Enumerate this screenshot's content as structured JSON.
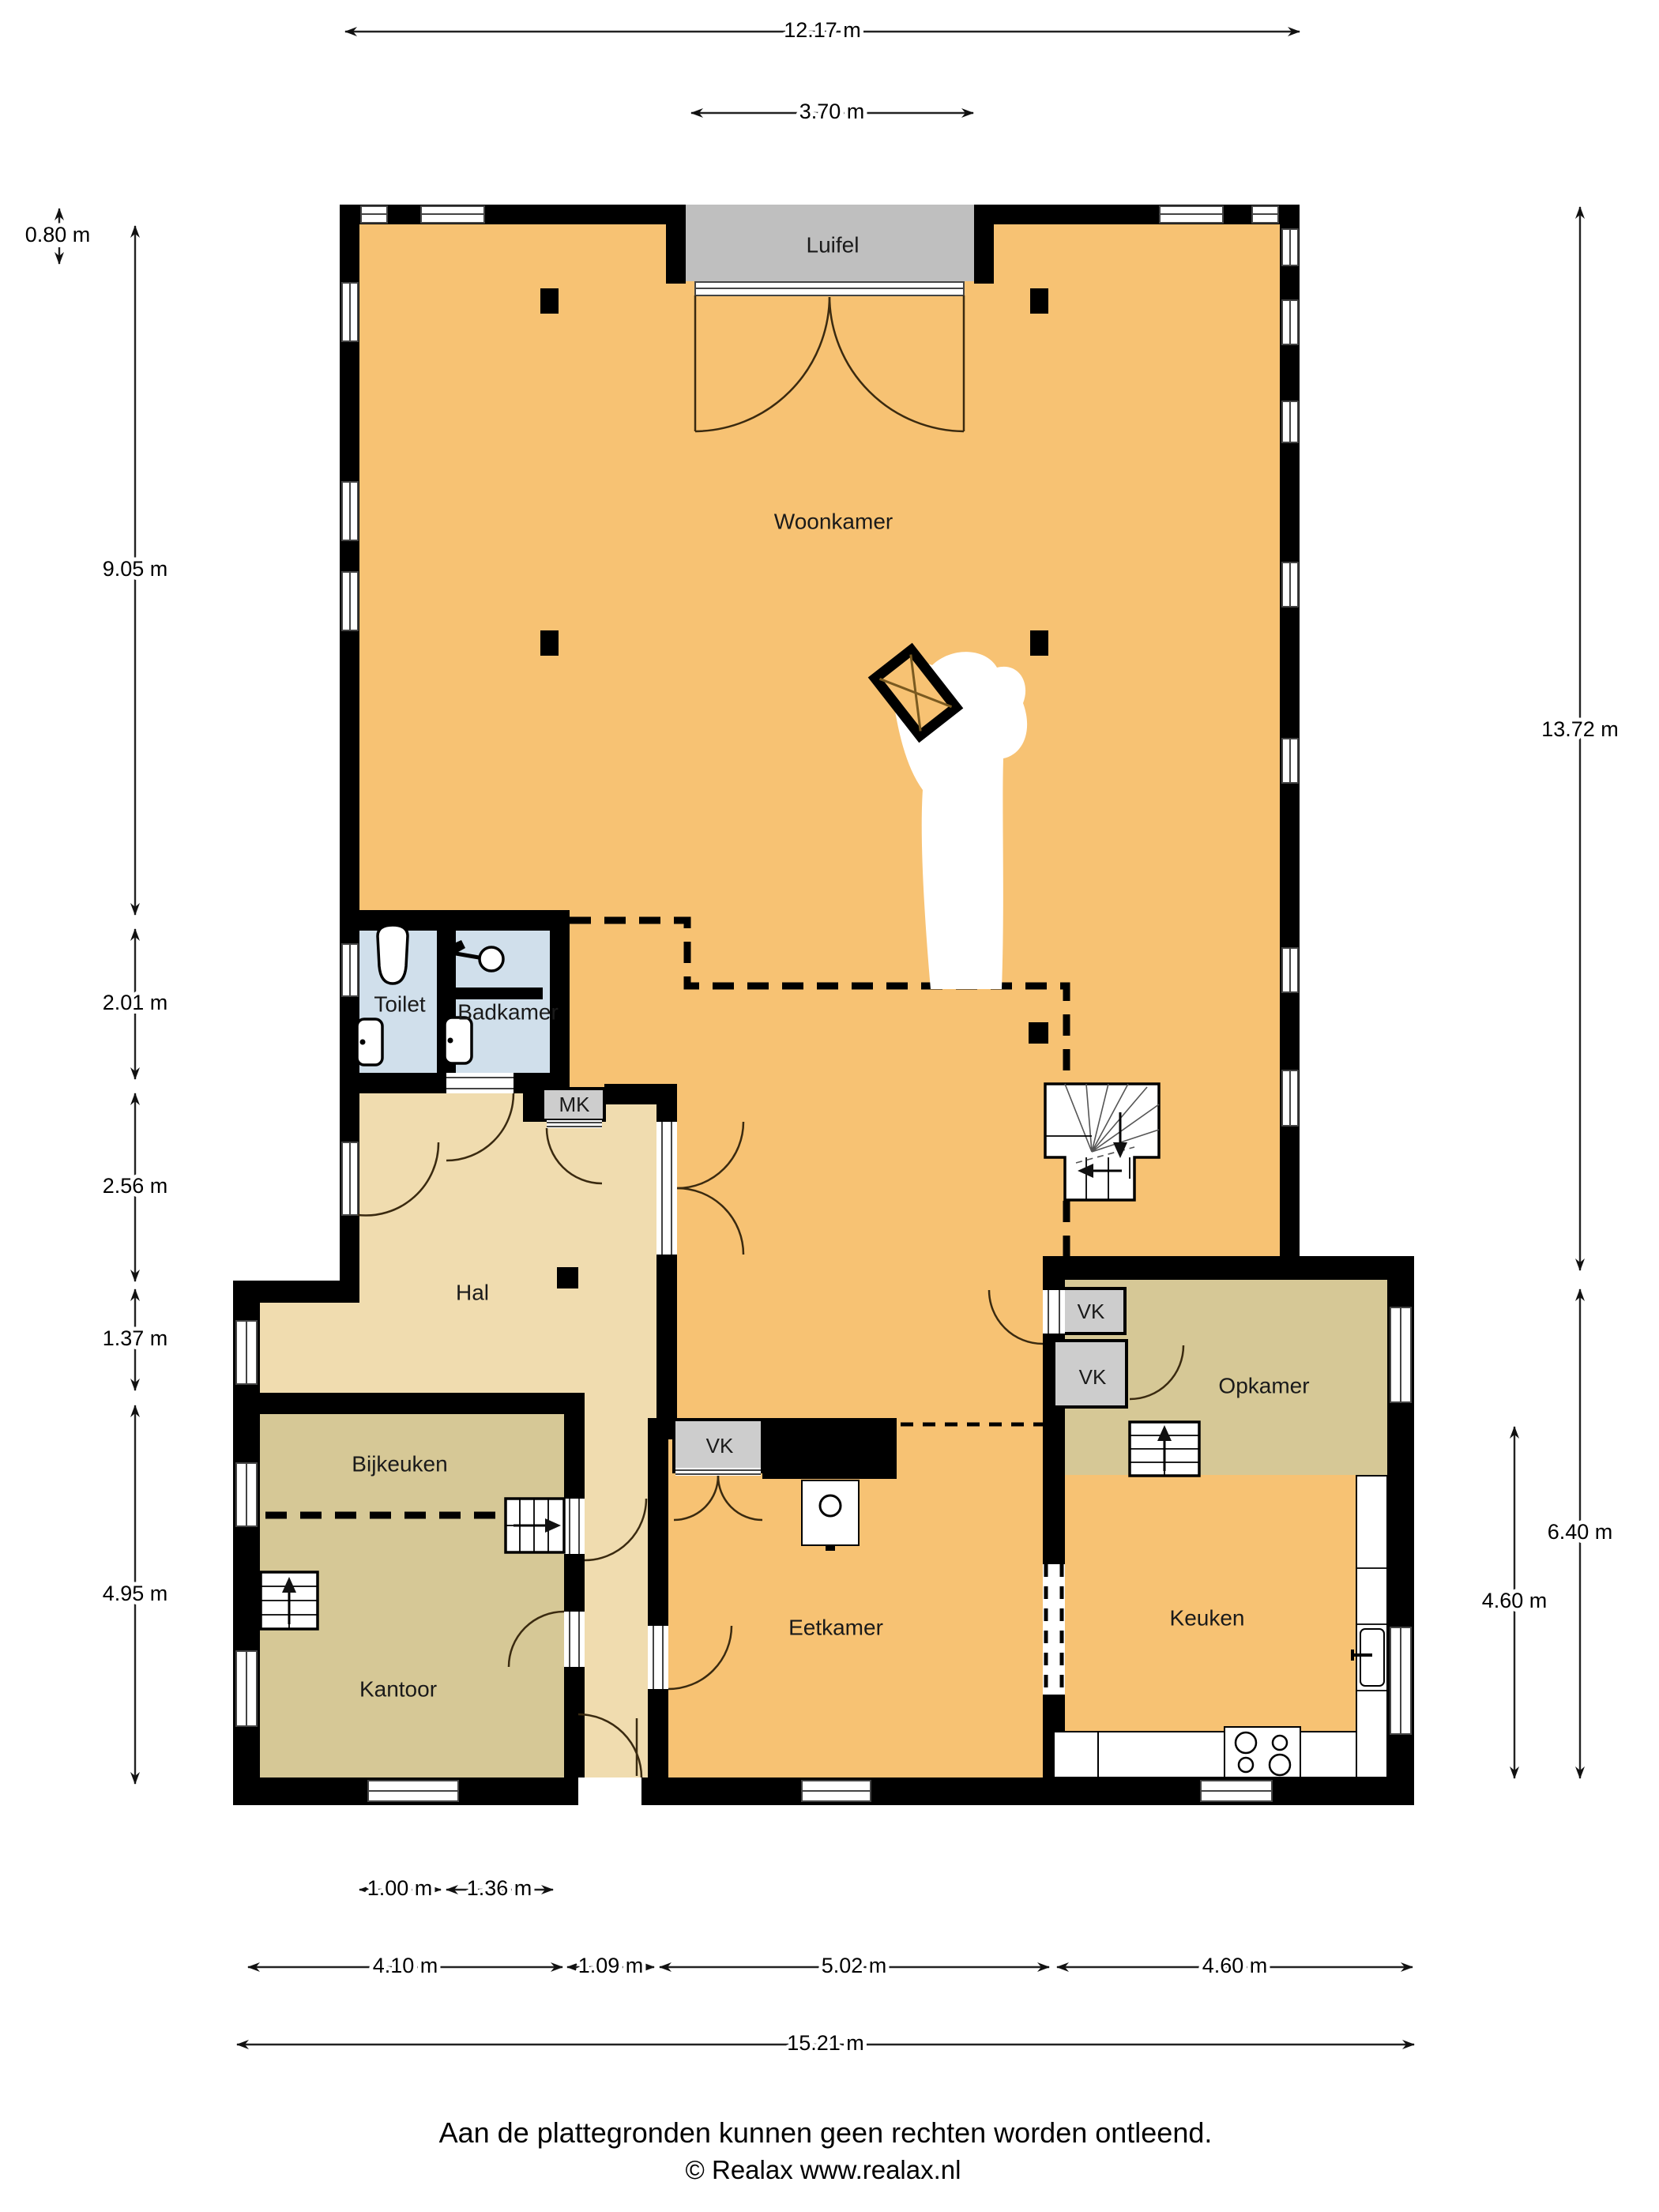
{
  "rooms": {
    "woonkamer": "Woonkamer",
    "luifel": "Luifel",
    "toilet": "Toilet",
    "badkamer": "Badkamer",
    "hal": "Hal",
    "mk": "MK",
    "vk": "VK",
    "bijkeuken": "Bijkeuken",
    "kantoor": "Kantoor",
    "eetkamer": "Eetkamer",
    "keuken": "Keuken",
    "opkamer": "Opkamer"
  },
  "dimensions": {
    "top_total": "12.17 m",
    "top_luifel": "3.70 m",
    "left_offset": "0.80 m",
    "left_1": "9.05 m",
    "left_2": "2.01 m",
    "left_3": "2.56 m",
    "left_4": "1.37 m",
    "left_5": "4.95 m",
    "right_1": "13.72 m",
    "right_2": "6.40 m",
    "right_3": "4.60 m",
    "bottom_inner_1": "1.00 m",
    "bottom_inner_2": "1.36 m",
    "bottom_1": "4.10 m",
    "bottom_2": "1.09 m",
    "bottom_3": "5.02 m",
    "bottom_4": "4.60 m",
    "bottom_total": "15.21 m"
  },
  "footer": {
    "line1": "Aan de plattegronden kunnen geen rechten worden ontleend.",
    "line2": "© Realax www.realax.nl"
  },
  "colors": {
    "living": "#F7C273",
    "hall": "#F0DCAF",
    "utility": "#D6C896",
    "bath": "#D0DFEB",
    "canopy": "#BFBFBF",
    "closet": "#CDCDCD",
    "wall": "#000000"
  }
}
